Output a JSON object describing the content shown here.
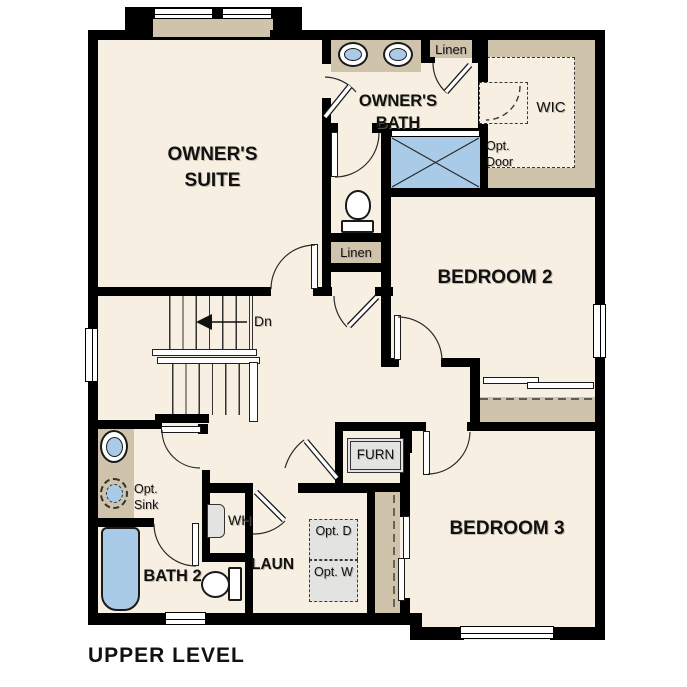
{
  "plan_title": "UPPER LEVEL",
  "rooms": {
    "owners_suite": "OWNER'S SUITE",
    "owners_bath": "OWNER'S BATH",
    "bedroom_2": "BEDROOM 2",
    "bedroom_3": "BEDROOM 3",
    "bath_2": "BATH 2",
    "laundry": "LAUN",
    "walk_in_closet": "WIC"
  },
  "closets": {
    "linen_bath": "Linen",
    "linen_hall": "Linen"
  },
  "annotations": {
    "stairs_down": "Dn",
    "furnace": "FURN",
    "water_heater": "WH",
    "optional_sink": "Opt. Sink",
    "optional_door": "Opt. Door",
    "optional_dryer": "Opt. D",
    "optional_washer": "Opt. W"
  },
  "colors": {
    "floor": "#f7efe2",
    "wall": "#000000",
    "cabinet_tan": "#cfc3ac",
    "fixture_blue": "#a9cbe8",
    "appliance_gray": "#e3e3e2"
  }
}
